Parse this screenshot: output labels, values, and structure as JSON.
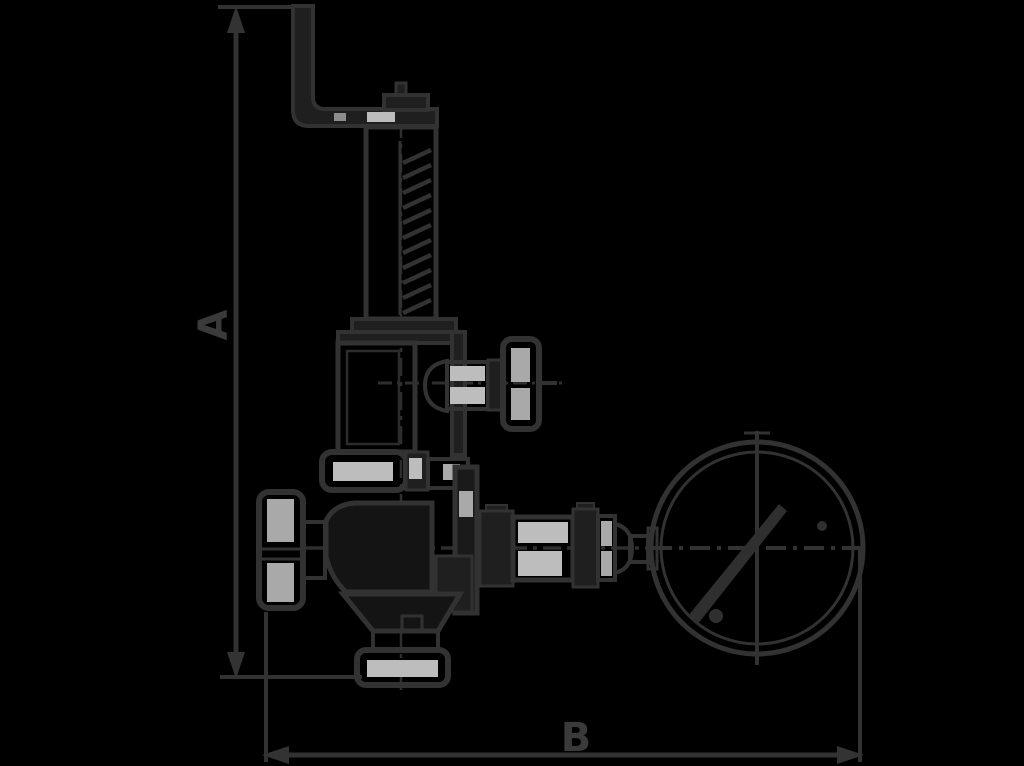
{
  "diagram": {
    "type": "technical-line-drawing",
    "subject": "spring-loaded safety relief valve with lever, side handwheel and pressure gauge",
    "dimension_labels": {
      "vertical": "A",
      "horizontal": "B"
    },
    "colors": {
      "background": "#000000",
      "line": "#323232",
      "solid_fill": "#1f1f1f",
      "highlight": "#bdbdbd",
      "label_text": "#3a3a3a"
    },
    "components": [
      "lever-handle",
      "spindle-cap",
      "spring-housing",
      "valve-bonnet",
      "side-outlet-handwheel",
      "upper-flange",
      "inlet-handwheel",
      "valve-body",
      "bottom-outlet-flange",
      "pipe-couplings",
      "pressure-gauge",
      "gauge-needle"
    ]
  }
}
